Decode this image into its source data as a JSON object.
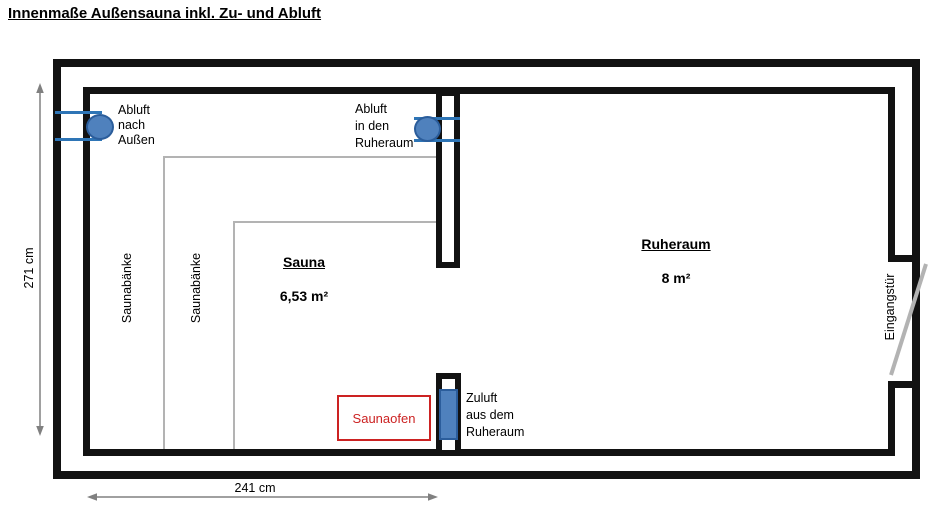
{
  "title": "Innenmaße Außensauna inkl. Zu- und Abluft",
  "rooms": {
    "sauna": {
      "name": "Sauna",
      "area": "6,53 m²"
    },
    "ruheraum": {
      "name": "Ruheraum",
      "area": "8 m²"
    }
  },
  "labels": {
    "abluft_aussen": "Abluft\nnach\nAußen",
    "abluft_ruheraum": "Abluft\nin den\nRuheraum",
    "zuluft_ruheraum": "Zuluft\naus dem\nRuheraum",
    "saunabaenke_1": "Saunabänke",
    "saunabaenke_2": "Saunabänke",
    "eingangstuer": "Eingangstür",
    "saunaofen": "Saunaofen"
  },
  "dimensions": {
    "vertical": "271 cm",
    "horizontal": "241 cm"
  },
  "colors": {
    "wall": "#121212",
    "vent_fill": "#4f81bd",
    "vent_stroke": "#2b5d9b",
    "vent_line": "#2e75b6",
    "oven_red": "#cc2222",
    "bench_gray": "#b3b3b3",
    "door_gray": "#b3b3b3",
    "dimension_gray": "#808080"
  }
}
